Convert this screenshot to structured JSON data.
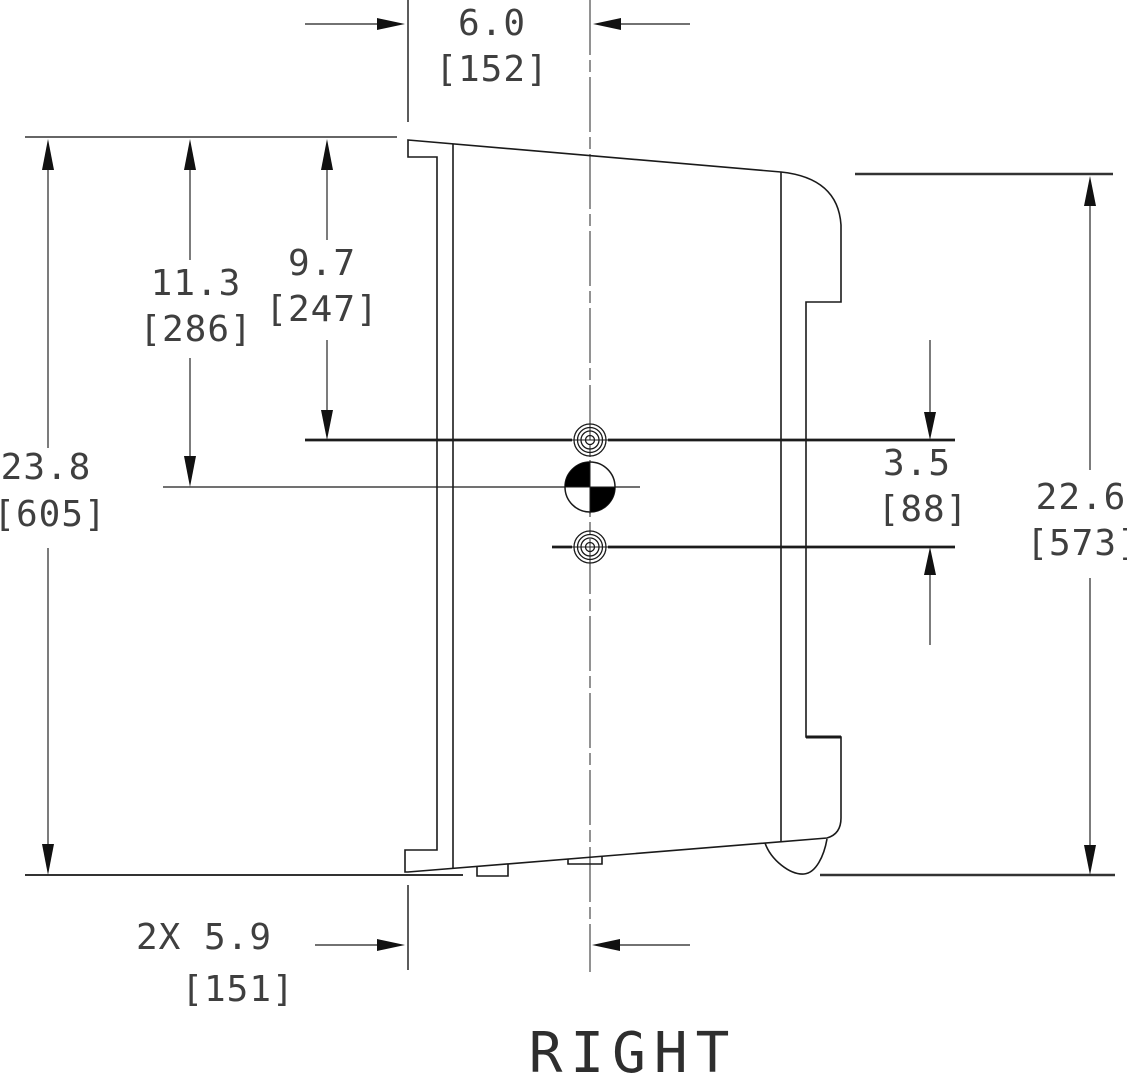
{
  "view": {
    "label": "RIGHT"
  },
  "units": {
    "primary": "inches",
    "secondary": "mm-in-brackets"
  },
  "dimensions": {
    "top_width_center_to_front": {
      "inches": "6.0",
      "mm": "[152]"
    },
    "top_to_center_of_gravity": {
      "inches": "11.3",
      "mm": "[286]"
    },
    "top_to_mount_hole": {
      "inches": "9.7",
      "mm": "[247]"
    },
    "overall_height": {
      "inches": "23.8",
      "mm": "[605]"
    },
    "mount_hole_spacing": {
      "inches": "3.5",
      "mm": "[88]"
    },
    "back_height": {
      "inches": "22.6",
      "mm": "[573]"
    },
    "bottom_center_to_front": {
      "inches": "2X 5.9",
      "mm": "[151]"
    }
  },
  "symbols": {
    "center_of_gravity": "cg-quadrant-symbol",
    "mount_holes": "concentric-circle-hole x2"
  },
  "colors": {
    "background": "#ffffff",
    "outline": "#1a1a1a",
    "dim_line": "#444444",
    "text": "#3f3f3f"
  }
}
